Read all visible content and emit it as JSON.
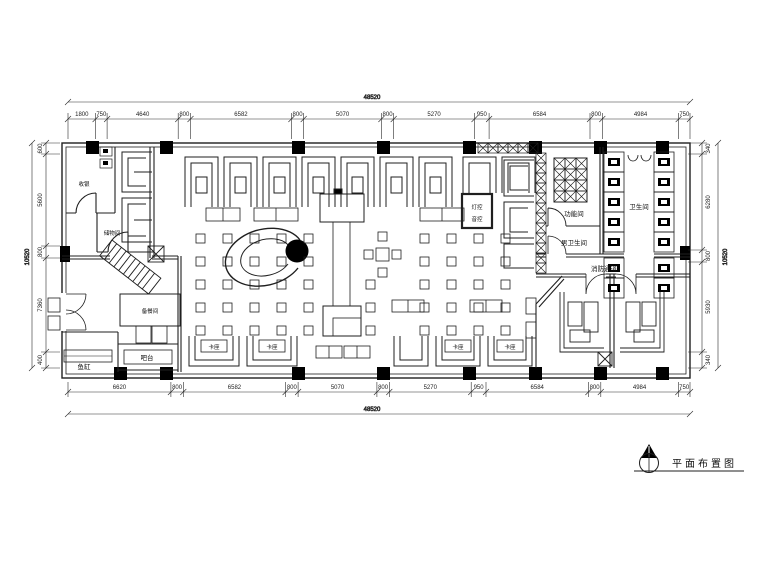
{
  "dims": {
    "top_total": "48520",
    "top": [
      "1800",
      "750",
      "4640",
      "800",
      "6582",
      "800",
      "5070",
      "800",
      "5270",
      "950",
      "6584",
      "800",
      "4984",
      "750"
    ],
    "bottom": [
      "6620",
      "800",
      "6582",
      "800",
      "5070",
      "800",
      "5270",
      "950",
      "6584",
      "800",
      "4984",
      "750"
    ],
    "bottom_total": "48520",
    "left": [
      "600",
      "5600",
      "800",
      "7360",
      "400"
    ],
    "left_total": "10520",
    "right": [
      "340",
      "6280",
      "800",
      "5930",
      "340"
    ],
    "right_total": "10520"
  },
  "rooms": {
    "cashier": "收银",
    "storage": "储物间",
    "service": "备餐间",
    "bar": "吧台",
    "fish_tank": "鱼缸",
    "control_1": "灯控",
    "control_2": "音控",
    "function_room": "功能间",
    "mens_wc": "男卫生间",
    "wc": "卫生间",
    "fire_passage": "消防通道",
    "booth": "卡座"
  },
  "title_block": {
    "drawing_title": "平面布置图"
  }
}
